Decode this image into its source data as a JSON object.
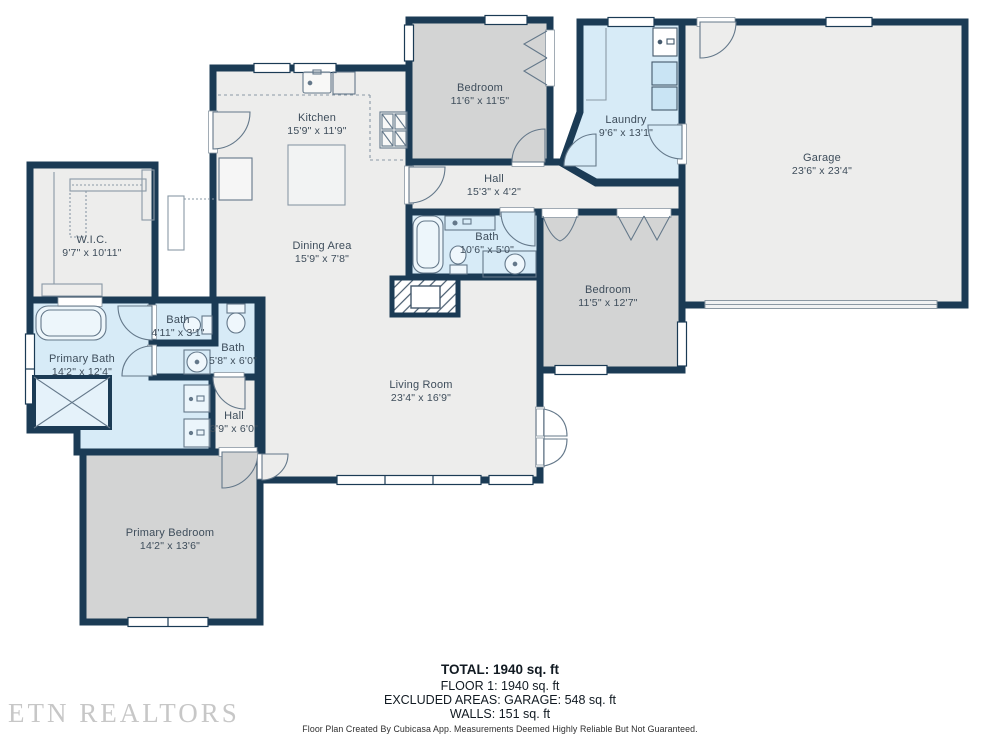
{
  "colors": {
    "wall": "#1b3b55",
    "floor": "#ededec",
    "bedroom_fill": "#d3d4d4",
    "wet_room_fill": "#d7ebf7",
    "fixture_stroke": "#64788a",
    "label_text": "#3e4d5b"
  },
  "rooms": [
    {
      "id": "wic",
      "name": "W.I.C.",
      "dims": "9'7\" x 10'11\""
    },
    {
      "id": "kitchen",
      "name": "Kitchen",
      "dims": "15'9\" x 11'9\""
    },
    {
      "id": "dining",
      "name": "Dining Area",
      "dims": "15'9\" x 7'8\""
    },
    {
      "id": "bedroom-top",
      "name": "Bedroom",
      "dims": "11'6\" x 11'5\""
    },
    {
      "id": "laundry",
      "name": "Laundry",
      "dims": "9'6\" x 13'1\""
    },
    {
      "id": "garage",
      "name": "Garage",
      "dims": "23'6\" x 23'4\""
    },
    {
      "id": "hall-top",
      "name": "Hall",
      "dims": "15'3\" x 4'2\""
    },
    {
      "id": "bath-main",
      "name": "Bath",
      "dims": "10'6\" x 5'0\""
    },
    {
      "id": "bedroom-right",
      "name": "Bedroom",
      "dims": "11'5\" x 12'7\""
    },
    {
      "id": "bath-small",
      "name": "Bath",
      "dims": "4'11\" x 3'1\""
    },
    {
      "id": "bath-mid",
      "name": "Bath",
      "dims": "5'8\" x 6'0\""
    },
    {
      "id": "primary-bath",
      "name": "Primary Bath",
      "dims": "14'2\" x 12'4\""
    },
    {
      "id": "hall-small",
      "name": "Hall",
      "dims": "3'9\" x 6'0\""
    },
    {
      "id": "living",
      "name": "Living Room",
      "dims": "23'4\" x 16'9\""
    },
    {
      "id": "primary-bedroom",
      "name": "Primary Bedroom",
      "dims": "14'2\" x 13'6\""
    }
  ],
  "summary": {
    "total": "TOTAL: 1940 sq. ft",
    "floor1": "FLOOR 1: 1940 sq. ft",
    "excluded": "EXCLUDED AREAS: GARAGE: 548 sq. ft",
    "walls": "WALLS: 151 sq. ft"
  },
  "disclaimer": "Floor Plan Created By Cubicasa App. Measurements Deemed Highly Reliable But Not Guaranteed.",
  "watermark": "ETN REALTORS"
}
